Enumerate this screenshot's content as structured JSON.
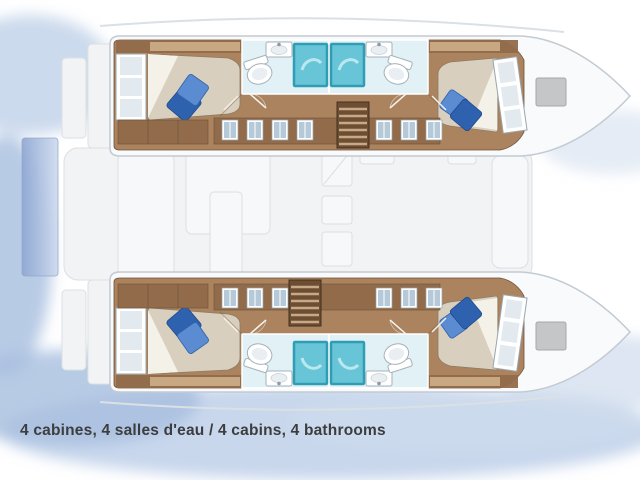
{
  "caption": {
    "text": "4 cabines, 4 salles d'eau / 4 cabins, 4 bathrooms"
  },
  "plan": {
    "type": "catamaran-deck-floor-plan",
    "orientation": "bow-right",
    "counts": {
      "cabins": 4,
      "bathrooms": 4
    },
    "hulls": [
      {
        "name": "upper-hull",
        "rooms": [
          "aft-double-cabin",
          "aft-bathroom",
          "forward-bathroom",
          "forward-double-cabin"
        ]
      },
      {
        "name": "lower-hull",
        "rooms": [
          "aft-double-cabin",
          "aft-bathroom",
          "forward-bathroom",
          "forward-double-cabin"
        ]
      }
    ]
  },
  "colors": {
    "background": "#ffffff",
    "hull-stroke": "#c2cad2",
    "hull-fill": "#f8fafb",
    "deck-fill": "#f1f3f5",
    "deck-stroke": "#dbe0e4",
    "furniture-fill": "#f6f8fa",
    "wood": "#ab835f",
    "wood-dark": "#6f5138",
    "wood-trim": "#916b4a",
    "cabinet-tan": "#c7a883",
    "bed-beige": "#d9cfbe",
    "bed-white": "#f4f1e9",
    "bed-stroke": "#8d7c64",
    "pillow-dark": "#2f62ae",
    "pillow-light": "#5b8bd0",
    "shower-fill": "#68c5d7",
    "shower-frame": "#2f9db4",
    "shower-swirl": "#c2ebf2",
    "bath-floor": "#e2f1f6",
    "fixture-white": "#ffffff",
    "fixture-stroke": "#a4b2ba",
    "fixture-inner": "#e8eef1",
    "window-frame": "#ffffff",
    "window-frame-stroke": "#99a5ad",
    "window-pane": "#e3eaef",
    "band-window": "#b6c9d8",
    "stairs-dark": "#6e4e33",
    "stairs-stroke": "#43301f",
    "stairs-tread": "#c8a987",
    "hatch-gray": "#c4c6c8",
    "hatch-stroke": "#a6a8aa",
    "water-1": "#b6cae6",
    "water-2": "#cfdced",
    "water-3": "#a6bede",
    "stern-box-stroke": "#8fa3c8",
    "caption-color": "#3c3d3f"
  }
}
